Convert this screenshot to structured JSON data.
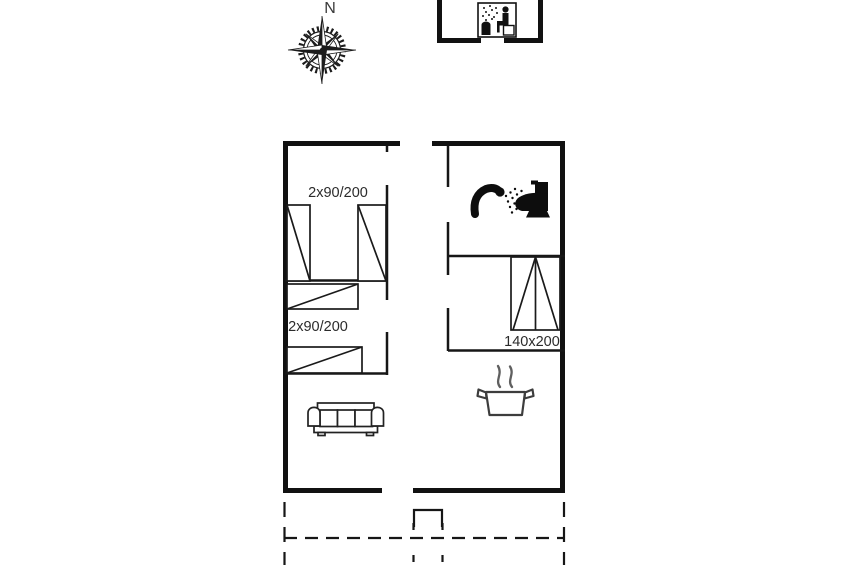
{
  "page": {
    "type": "holiday-home floor plan drawing",
    "background_color": "#ffffff",
    "ink_color": "#161616",
    "steam_color": "#5f5f5f"
  },
  "compass": {
    "north_label": "N",
    "icon": "compass-rose-icon"
  },
  "sauna_annex": {
    "icon": "sauna-pictogram-icon",
    "description": "detached small building with sauna pictogram"
  },
  "floor_plan": {
    "bedroom_top_left": {
      "bed_label": "2x90/200",
      "beds": 2
    },
    "bedroom_mid_left": {
      "bed_label": "2x90/200",
      "beds": 2
    },
    "bedroom_right": {
      "bed_label": "140x200",
      "beds": 1
    },
    "bathroom": {
      "icons": [
        "shower-icon",
        "toilet-icon"
      ]
    },
    "kitchen": {
      "icons": [
        "stove-pot-icon"
      ]
    },
    "living_room": {
      "icons": [
        "sofa-icon"
      ]
    },
    "outside": {
      "features": [
        "entrance-step",
        "dashed-terrace-outline",
        "dashed-path"
      ]
    }
  }
}
